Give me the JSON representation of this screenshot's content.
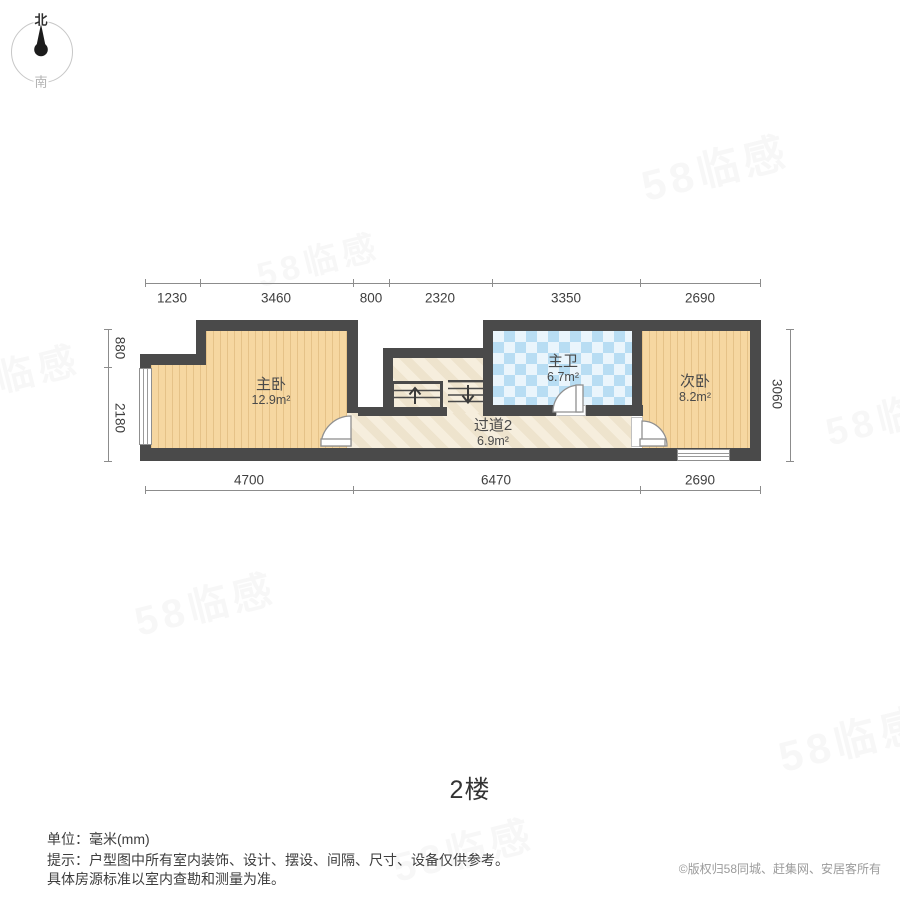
{
  "title": "2楼",
  "compass": {
    "north": "北",
    "south": "南"
  },
  "watermark": {
    "text": "58临感"
  },
  "floor_plan": {
    "rooms": [
      {
        "name": "主卧",
        "area": "12.9m²"
      },
      {
        "name": "主卫",
        "area": "6.7m²"
      },
      {
        "name": "过道2",
        "area": "6.9m²"
      },
      {
        "name": "次卧",
        "area": "8.2m²"
      }
    ],
    "dimensions": {
      "top": [
        "1230",
        "3460",
        "800",
        "2320",
        "3350",
        "2690"
      ],
      "bottom": [
        "4700",
        "6470",
        "2690"
      ],
      "left": [
        "880",
        "2180"
      ],
      "right": [
        "3060"
      ]
    }
  },
  "footer": {
    "unit_line": "单位：毫米(mm)",
    "note_line1": "提示：户型图中所有室内装饰、设计、摆设、间隔、尺寸、设备仅供参考。",
    "note_line2": "具体房源标准以室内查勘和测量为准。",
    "copyright": "©版权归58同城、赶集网、安居客所有"
  },
  "colors": {
    "wall": "#4a4a4a",
    "wood_floor": "#f6d7a1",
    "tile_floor": "#ddeffa",
    "marble_floor": "#f2e7d0",
    "dim_text": "#3f3f3f",
    "copyright_text": "#9b9b9b"
  }
}
